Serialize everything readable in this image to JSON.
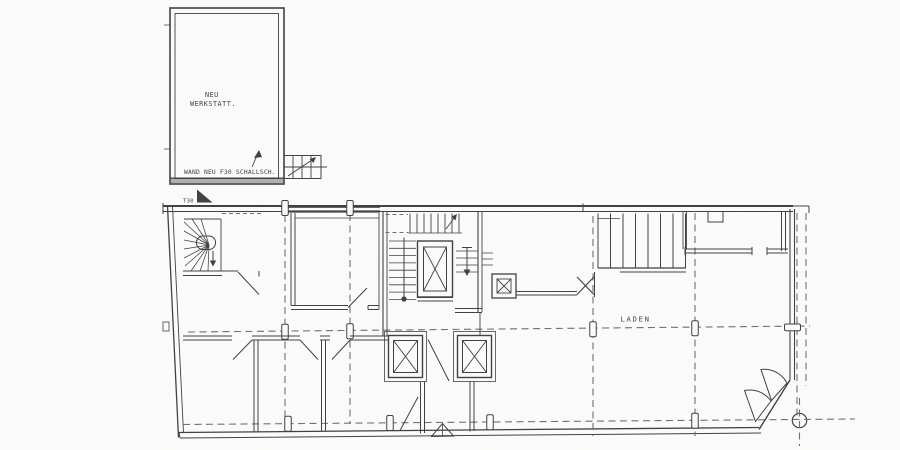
{
  "labels": {
    "workshop_line1": "NEU",
    "workshop_line2": "WERKSTATT.",
    "wall_note": "WAND NEU F30 SCHALLSCH.",
    "fire_door": "T30",
    "shop": "LADEN"
  },
  "colors": {
    "ink": "#3f3f3f",
    "ink_light": "#6e6e6e",
    "paper": "#fcfcfb"
  }
}
